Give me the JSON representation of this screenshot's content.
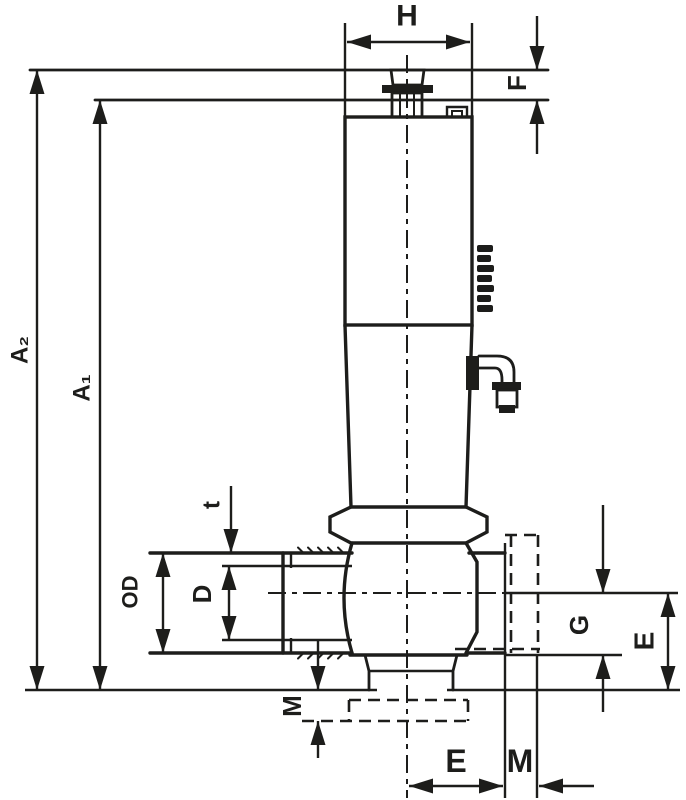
{
  "drawing": {
    "ink_color": "#1d1d1b",
    "background_color": "#ffffff",
    "labels": {
      "H": "H",
      "F": "F",
      "A2": "A₂",
      "A1": "A₁",
      "t": "t",
      "OD": "OD",
      "D": "D",
      "G": "G",
      "E_right": "E",
      "M_left": "M",
      "E_bottom": "E",
      "M_bottom": "M"
    }
  }
}
